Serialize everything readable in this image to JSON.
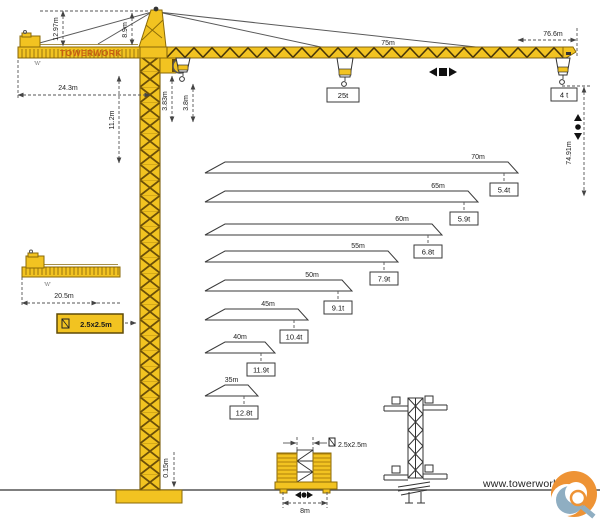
{
  "branding": {
    "jib_text": "TOWERWORK",
    "website": "www.towerwork.net"
  },
  "colors": {
    "crane_yellow": "#F2C321",
    "lattice_dark": "#473508",
    "dimension_line": "#555555",
    "brand_orange": "#c75f12",
    "logo_orange": "#EE9335",
    "logo_blue": "#8FAEC2"
  },
  "dims": {
    "head_height": "12.97m",
    "apex_height": "8.9m",
    "counter_jib_length": "24.3m",
    "mast_top_section": "11.2m",
    "hook_clearance_a": "3.83m",
    "hook_clearance_b": "3.8m",
    "jib_length": "75m",
    "max_radius": "76.6m",
    "max_hook_height": "74.91m",
    "max_capacity": "25t",
    "tip_capacity": "4 t",
    "foundation_offset": "0.15m",
    "counterweight_mark": "'W'"
  },
  "counter_jib_detail": {
    "length": "20.5m",
    "counterweight_mark": "'W'"
  },
  "mast_badge": {
    "label": "2.5x2.5m"
  },
  "inner_tower": {
    "section_label": "2.5x2.5m",
    "base_width": "8m"
  },
  "chart_data": {
    "type": "table",
    "title": "Tip load capacity by jib length",
    "columns": [
      "Jib length",
      "Capacity at tip"
    ],
    "rows": [
      [
        "70m",
        "5.4t"
      ],
      [
        "65m",
        "5.9t"
      ],
      [
        "60m",
        "6.8t"
      ],
      [
        "55m",
        "7.9t"
      ],
      [
        "50m",
        "9.1t"
      ],
      [
        "45m",
        "10.4t"
      ],
      [
        "40m",
        "11.9t"
      ],
      [
        "35m",
        "12.8t"
      ]
    ],
    "jib_lengths_m": [
      70,
      65,
      60,
      55,
      50,
      45,
      40,
      35
    ],
    "tip_capacities_t": [
      5.4,
      5.9,
      6.8,
      7.9,
      9.1,
      10.4,
      11.9,
      12.8
    ]
  }
}
